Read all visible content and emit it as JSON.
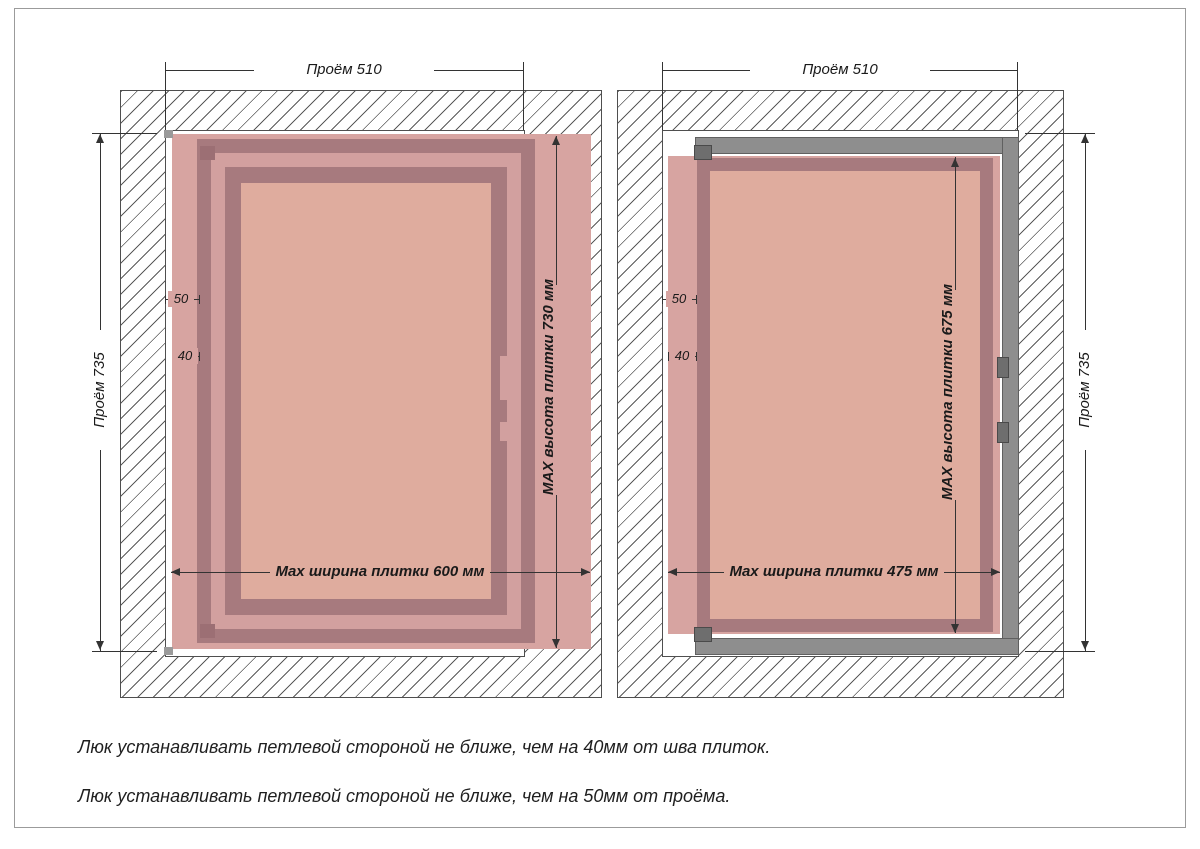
{
  "drawing_title": "Установка люка под плитку — схема размеров",
  "diagrams": {
    "left": {
      "opening_width": "Проём 510",
      "opening_height": "Проём 735",
      "tile_height": "MAX высота плитки 730 мм",
      "tile_width": "Max ширина плитки 600 мм",
      "offset_from_opening": "50",
      "offset_from_seam": "40"
    },
    "right": {
      "opening_width": "Проём 510",
      "opening_height": "Проём 735",
      "tile_height": "MAX высота плитки 675 мм",
      "tile_width": "Max ширина плитки 475 мм",
      "offset_from_opening": "50",
      "offset_from_seam": "40"
    }
  },
  "notes": {
    "line1": "Люк устанавливать петлевой стороной не ближе, чем на 40мм от шва плиток.",
    "line2": "Люк устанавливать петлевой стороной не ближе, чем на 50мм от проёма."
  },
  "colors": {
    "tile_zone": "#d7a4a1",
    "door_frame": "#a77a7e",
    "door_gap_band": "#d2a09f",
    "door_panel": "#dfac9e",
    "metal_frame": "#8e8e8e",
    "hardware_gray": "#6e6e6e",
    "hinge_mauve": "#9c6f74",
    "wall_hatch_line": "#5a5a5a",
    "dimension_line": "#333333",
    "page_border": "#9b9b9b"
  }
}
